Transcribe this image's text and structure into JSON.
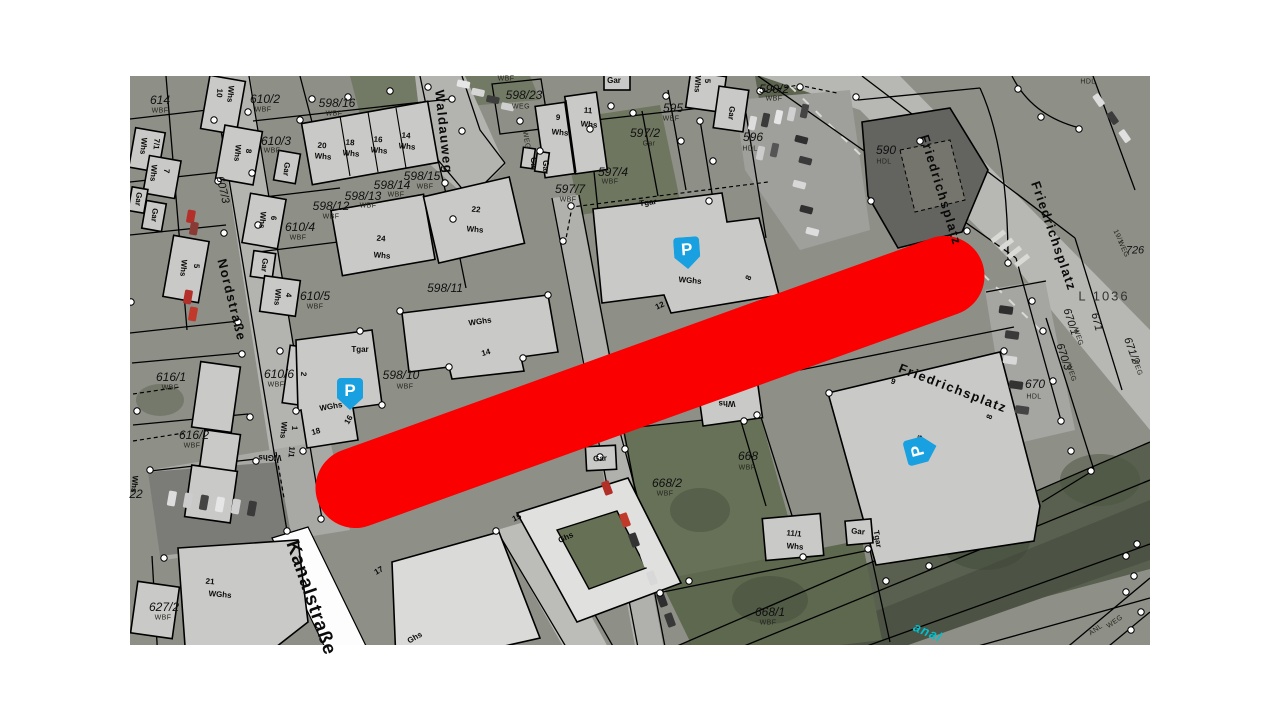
{
  "map": {
    "colors": {
      "highlight_red": "#fa0000",
      "parking_blue": "#18a0e0",
      "canal_cyan": "#00c0d0"
    },
    "parking": {
      "letter": "P",
      "spots": [
        {
          "x": 687,
          "y": 253,
          "r": -4
        },
        {
          "x": 350,
          "y": 394,
          "r": 0
        },
        {
          "x": 921,
          "y": 450,
          "r": -105
        }
      ]
    },
    "labels": [
      {
        "t": "Waldauweg",
        "x": 444,
        "y": 132,
        "r": 84,
        "c": "street"
      },
      {
        "t": "Nordstraße",
        "x": 232,
        "y": 300,
        "r": 76,
        "c": "street"
      },
      {
        "t": "Kanalstraße",
        "x": 311,
        "y": 598,
        "r": 71,
        "c": "street-lg"
      },
      {
        "t": "Friedrichsplatz",
        "x": 941,
        "y": 190,
        "r": 73,
        "c": "street"
      },
      {
        "t": "Friedrichsplatz",
        "x": 1054,
        "y": 236,
        "r": 71,
        "c": "street"
      },
      {
        "t": "Friedrichsplatz",
        "x": 953,
        "y": 388,
        "r": 21,
        "c": "street"
      },
      {
        "t": "anal",
        "x": 928,
        "y": 632,
        "r": 23,
        "c": "canal"
      },
      {
        "t": "L 1036",
        "x": 1104,
        "y": 296,
        "r": 0,
        "c": "lroad"
      },
      {
        "t": "607/3",
        "x": 222,
        "y": 190,
        "r": 77,
        "c": "roadnum"
      },
      {
        "t": "671",
        "x": 1096,
        "y": 322,
        "r": 76,
        "c": "roadnum"
      },
      {
        "t": "670/1",
        "x": 1070,
        "y": 322,
        "r": 72,
        "c": "roadnum"
      },
      {
        "t": "WEG",
        "x": 1078,
        "y": 337,
        "r": 72,
        "c": "sub"
      },
      {
        "t": "670/3",
        "x": 1063,
        "y": 357,
        "r": 72,
        "c": "roadnum"
      },
      {
        "t": "WEG",
        "x": 1071,
        "y": 373,
        "r": 72,
        "c": "sub"
      },
      {
        "t": "671/2",
        "x": 1131,
        "y": 351,
        "r": 70,
        "c": "roadnum"
      },
      {
        "t": "WEG",
        "x": 1137,
        "y": 367,
        "r": 70,
        "c": "sub"
      },
      {
        "t": "19/1",
        "x": 1118,
        "y": 237,
        "r": 65,
        "c": "sub"
      },
      {
        "t": "WEG",
        "x": 1123,
        "y": 249,
        "r": 65,
        "c": "sub"
      },
      {
        "t": "726",
        "x": 1135,
        "y": 251,
        "r": 0,
        "c": "roadnum"
      },
      {
        "t": "HDL",
        "x": 1088,
        "y": 82,
        "r": 0,
        "c": "sub"
      },
      {
        "t": "WEG",
        "x": 1115,
        "y": 622,
        "r": -35,
        "c": "sub"
      },
      {
        "t": "ANL",
        "x": 1096,
        "y": 630,
        "r": -35,
        "c": "sub"
      },
      {
        "t": "614",
        "x": 160,
        "y": 100,
        "r": 0,
        "c": "parcel"
      },
      {
        "t": "WBF",
        "x": 160,
        "y": 111,
        "r": 0,
        "c": "sub"
      },
      {
        "t": "610/2",
        "x": 265,
        "y": 99,
        "r": 0,
        "c": "parcel"
      },
      {
        "t": "WBF",
        "x": 263,
        "y": 110,
        "r": 0,
        "c": "sub"
      },
      {
        "t": "598/16",
        "x": 337,
        "y": 103,
        "r": 0,
        "c": "parcel"
      },
      {
        "t": "WBF",
        "x": 334,
        "y": 114,
        "r": 0,
        "c": "sub"
      },
      {
        "t": "610/3",
        "x": 276,
        "y": 141,
        "r": 0,
        "c": "parcel"
      },
      {
        "t": "WBF",
        "x": 272,
        "y": 151,
        "r": 0,
        "c": "sub"
      },
      {
        "t": "598/12",
        "x": 331,
        "y": 206,
        "r": 0,
        "c": "parcel"
      },
      {
        "t": "WBF",
        "x": 331,
        "y": 217,
        "r": 0,
        "c": "sub"
      },
      {
        "t": "598/13",
        "x": 363,
        "y": 196,
        "r": 0,
        "c": "parcel"
      },
      {
        "t": "WBF",
        "x": 368,
        "y": 206,
        "r": 0,
        "c": "sub"
      },
      {
        "t": "598/14",
        "x": 392,
        "y": 185,
        "r": 0,
        "c": "parcel"
      },
      {
        "t": "WBF",
        "x": 396,
        "y": 195,
        "r": 0,
        "c": "sub"
      },
      {
        "t": "598/15",
        "x": 422,
        "y": 176,
        "r": 0,
        "c": "parcel"
      },
      {
        "t": "WBF",
        "x": 425,
        "y": 187,
        "r": 0,
        "c": "sub"
      },
      {
        "t": "598/11",
        "x": 445,
        "y": 288,
        "r": 0,
        "c": "parcel"
      },
      {
        "t": "610/4",
        "x": 300,
        "y": 227,
        "r": 0,
        "c": "parcel"
      },
      {
        "t": "WBF",
        "x": 298,
        "y": 238,
        "r": 0,
        "c": "sub"
      },
      {
        "t": "610/5",
        "x": 315,
        "y": 296,
        "r": 0,
        "c": "parcel"
      },
      {
        "t": "WBF",
        "x": 315,
        "y": 307,
        "r": 0,
        "c": "sub"
      },
      {
        "t": "610/6",
        "x": 279,
        "y": 374,
        "r": 0,
        "c": "parcel"
      },
      {
        "t": "WBF",
        "x": 276,
        "y": 385,
        "r": 0,
        "c": "sub"
      },
      {
        "t": "616/1",
        "x": 171,
        "y": 377,
        "r": 0,
        "c": "parcel"
      },
      {
        "t": "WBF",
        "x": 170,
        "y": 388,
        "r": 0,
        "c": "sub"
      },
      {
        "t": "616/2",
        "x": 194,
        "y": 435,
        "r": 0,
        "c": "parcel"
      },
      {
        "t": "WBF",
        "x": 192,
        "y": 446,
        "r": 0,
        "c": "sub"
      },
      {
        "t": "627/2",
        "x": 164,
        "y": 607,
        "r": 0,
        "c": "parcel"
      },
      {
        "t": "WBF",
        "x": 163,
        "y": 618,
        "r": 0,
        "c": "sub"
      },
      {
        "t": "598/23",
        "x": 524,
        "y": 95,
        "r": 0,
        "c": "parcel"
      },
      {
        "t": "WEG",
        "x": 521,
        "y": 107,
        "r": 0,
        "c": "sub"
      },
      {
        "t": "597/2",
        "x": 645,
        "y": 133,
        "r": 0,
        "c": "parcel"
      },
      {
        "t": "Gar",
        "x": 649,
        "y": 144,
        "r": 0,
        "c": "sub"
      },
      {
        "t": "597/4",
        "x": 613,
        "y": 172,
        "r": 0,
        "c": "parcel"
      },
      {
        "t": "WBF",
        "x": 610,
        "y": 182,
        "r": 0,
        "c": "sub"
      },
      {
        "t": "597/7",
        "x": 570,
        "y": 189,
        "r": 0,
        "c": "parcel"
      },
      {
        "t": "WBF",
        "x": 568,
        "y": 200,
        "r": 0,
        "c": "sub"
      },
      {
        "t": "595",
        "x": 673,
        "y": 108,
        "r": 0,
        "c": "parcel"
      },
      {
        "t": "WBF",
        "x": 671,
        "y": 119,
        "r": 0,
        "c": "sub"
      },
      {
        "t": "596",
        "x": 753,
        "y": 137,
        "r": 0,
        "c": "parcel"
      },
      {
        "t": "HDL",
        "x": 750,
        "y": 149,
        "r": 0,
        "c": "sub"
      },
      {
        "t": "590/2",
        "x": 774,
        "y": 89,
        "r": 0,
        "c": "parcel"
      },
      {
        "t": "WBF",
        "x": 774,
        "y": 99,
        "r": 0,
        "c": "sub"
      },
      {
        "t": "590",
        "x": 886,
        "y": 150,
        "r": 0,
        "c": "parcel"
      },
      {
        "t": "HDL",
        "x": 884,
        "y": 162,
        "r": 0,
        "c": "sub"
      },
      {
        "t": "668/2",
        "x": 667,
        "y": 483,
        "r": 0,
        "c": "parcel"
      },
      {
        "t": "WBF",
        "x": 665,
        "y": 494,
        "r": 0,
        "c": "sub"
      },
      {
        "t": "668",
        "x": 748,
        "y": 456,
        "r": 0,
        "c": "parcel"
      },
      {
        "t": "WBF",
        "x": 747,
        "y": 468,
        "r": 0,
        "c": "sub"
      },
      {
        "t": "668/1",
        "x": 770,
        "y": 612,
        "r": 0,
        "c": "parcel"
      },
      {
        "t": "WBF",
        "x": 768,
        "y": 623,
        "r": 0,
        "c": "sub"
      },
      {
        "t": "670",
        "x": 1035,
        "y": 384,
        "r": 0,
        "c": "parcel"
      },
      {
        "t": "HDL",
        "x": 1034,
        "y": 397,
        "r": 0,
        "c": "sub"
      },
      {
        "t": "598/10",
        "x": 401,
        "y": 375,
        "r": 0,
        "c": "parcel"
      },
      {
        "t": "WBF",
        "x": 405,
        "y": 387,
        "r": 0,
        "c": "sub"
      },
      {
        "t": "22",
        "x": 136,
        "y": 494,
        "r": 0,
        "c": "parcel"
      },
      {
        "t": "WBF",
        "x": 506,
        "y": 79,
        "r": 0,
        "c": "sub"
      },
      {
        "t": "Whs",
        "x": 230,
        "y": 94,
        "r": 95,
        "c": "bldg"
      },
      {
        "t": "10",
        "x": 219,
        "y": 93,
        "r": 95,
        "c": "bldg"
      },
      {
        "t": "Whs",
        "x": 143,
        "y": 146,
        "r": 95,
        "c": "bldg"
      },
      {
        "t": "7/1",
        "x": 156,
        "y": 144,
        "r": 95,
        "c": "bldg"
      },
      {
        "t": "Whs",
        "x": 153,
        "y": 173,
        "r": 95,
        "c": "bldg"
      },
      {
        "t": "7",
        "x": 166,
        "y": 171,
        "r": 95,
        "c": "bldg"
      },
      {
        "t": "Gar",
        "x": 138,
        "y": 199,
        "r": 95,
        "c": "bldg"
      },
      {
        "t": "Gar",
        "x": 154,
        "y": 215,
        "r": 95,
        "c": "bldg"
      },
      {
        "t": "Whs",
        "x": 183,
        "y": 268,
        "r": 95,
        "c": "bldg"
      },
      {
        "t": "5",
        "x": 196,
        "y": 266,
        "r": 95,
        "c": "bldg"
      },
      {
        "t": "Whs",
        "x": 237,
        "y": 153,
        "r": 95,
        "c": "bldg"
      },
      {
        "t": "8",
        "x": 248,
        "y": 151,
        "r": 95,
        "c": "bldg"
      },
      {
        "t": "Gar",
        "x": 286,
        "y": 169,
        "r": 95,
        "c": "bldg"
      },
      {
        "t": "Whs",
        "x": 262,
        "y": 220,
        "r": 95,
        "c": "bldg"
      },
      {
        "t": "6",
        "x": 273,
        "y": 218,
        "r": 95,
        "c": "bldg"
      },
      {
        "t": "Gar",
        "x": 264,
        "y": 265,
        "r": 95,
        "c": "bldg"
      },
      {
        "t": "Whs",
        "x": 277,
        "y": 297,
        "r": 95,
        "c": "bldg"
      },
      {
        "t": "4",
        "x": 288,
        "y": 295,
        "r": 95,
        "c": "bldg"
      },
      {
        "t": "2",
        "x": 303,
        "y": 374,
        "r": 95,
        "c": "bldg"
      },
      {
        "t": "Whs",
        "x": 283,
        "y": 430,
        "r": 95,
        "c": "bldg"
      },
      {
        "t": "1",
        "x": 294,
        "y": 428,
        "r": 95,
        "c": "bldg"
      },
      {
        "t": "WGhs",
        "x": 270,
        "y": 457,
        "r": 180,
        "c": "bldg"
      },
      {
        "t": "1/1",
        "x": 291,
        "y": 452,
        "r": 95,
        "c": "bldg"
      },
      {
        "t": "20",
        "x": 322,
        "y": 146,
        "r": 5,
        "c": "bldg"
      },
      {
        "t": "Whs",
        "x": 323,
        "y": 157,
        "r": 5,
        "c": "bldg"
      },
      {
        "t": "18",
        "x": 350,
        "y": 143,
        "r": 5,
        "c": "bldg"
      },
      {
        "t": "Whs",
        "x": 351,
        "y": 154,
        "r": 5,
        "c": "bldg"
      },
      {
        "t": "16",
        "x": 378,
        "y": 140,
        "r": 5,
        "c": "bldg"
      },
      {
        "t": "Whs",
        "x": 379,
        "y": 151,
        "r": 5,
        "c": "bldg"
      },
      {
        "t": "14",
        "x": 406,
        "y": 136,
        "r": 5,
        "c": "bldg"
      },
      {
        "t": "Whs",
        "x": 407,
        "y": 147,
        "r": 5,
        "c": "bldg"
      },
      {
        "t": "24",
        "x": 381,
        "y": 239,
        "r": 5,
        "c": "bldg"
      },
      {
        "t": "Whs",
        "x": 382,
        "y": 256,
        "r": 5,
        "c": "bldg"
      },
      {
        "t": "22",
        "x": 476,
        "y": 210,
        "r": 5,
        "c": "bldg"
      },
      {
        "t": "Whs",
        "x": 475,
        "y": 230,
        "r": 5,
        "c": "bldg"
      },
      {
        "t": "9",
        "x": 558,
        "y": 118,
        "r": 5,
        "c": "bldg"
      },
      {
        "t": "Whs",
        "x": 560,
        "y": 133,
        "r": 5,
        "c": "bldg"
      },
      {
        "t": "11",
        "x": 588,
        "y": 111,
        "r": 5,
        "c": "bldg"
      },
      {
        "t": "Whs",
        "x": 589,
        "y": 125,
        "r": 5,
        "c": "bldg"
      },
      {
        "t": "Gar",
        "x": 614,
        "y": 81,
        "r": 0,
        "c": "bldg"
      },
      {
        "t": "Gar",
        "x": 731,
        "y": 113,
        "r": 95,
        "c": "bldg"
      },
      {
        "t": "Whs",
        "x": 697,
        "y": 84,
        "r": 93,
        "c": "bldg"
      },
      {
        "t": "5",
        "x": 707,
        "y": 81,
        "r": 93,
        "c": "bldg"
      },
      {
        "t": "Gar",
        "x": 533,
        "y": 164,
        "r": 90,
        "c": "bldg"
      },
      {
        "t": "Gar",
        "x": 545,
        "y": 167,
        "r": 90,
        "c": "bldg"
      },
      {
        "t": "WEG",
        "x": 526,
        "y": 140,
        "r": 80,
        "c": "sub"
      },
      {
        "t": "WGhs",
        "x": 690,
        "y": 281,
        "r": 5,
        "c": "bldg"
      },
      {
        "t": "8",
        "x": 749,
        "y": 278,
        "r": -65,
        "c": "bldg"
      },
      {
        "t": "12",
        "x": 660,
        "y": 306,
        "r": -25,
        "c": "bldg"
      },
      {
        "t": "Tgar",
        "x": 648,
        "y": 203,
        "r": -8,
        "c": "bldg"
      },
      {
        "t": "WGhs",
        "x": 480,
        "y": 322,
        "r": -8,
        "c": "bldg"
      },
      {
        "t": "14",
        "x": 486,
        "y": 353,
        "r": -15,
        "c": "bldg"
      },
      {
        "t": "WGhs",
        "x": 331,
        "y": 407,
        "r": -10,
        "c": "bldg"
      },
      {
        "t": "16",
        "x": 349,
        "y": 420,
        "r": -60,
        "c": "bldg"
      },
      {
        "t": "18",
        "x": 316,
        "y": 432,
        "r": -15,
        "c": "bldg"
      },
      {
        "t": "Tgar",
        "x": 360,
        "y": 350,
        "r": 0,
        "c": "bldg"
      },
      {
        "t": "Tgar",
        "x": 877,
        "y": 539,
        "r": 80,
        "c": "bldg"
      },
      {
        "t": "21",
        "x": 210,
        "y": 582,
        "r": 5,
        "c": "bldg"
      },
      {
        "t": "WGhs",
        "x": 220,
        "y": 595,
        "r": 5,
        "c": "bldg"
      },
      {
        "t": "17",
        "x": 379,
        "y": 571,
        "r": -30,
        "c": "bldg"
      },
      {
        "t": "15",
        "x": 517,
        "y": 518,
        "r": -25,
        "c": "bldg"
      },
      {
        "t": "Ghs",
        "x": 566,
        "y": 538,
        "r": -25,
        "c": "bldg"
      },
      {
        "t": "Ghs",
        "x": 415,
        "y": 638,
        "r": -30,
        "c": "bldg"
      },
      {
        "t": "WGhs",
        "x": 917,
        "y": 446,
        "r": -72,
        "c": "bldg"
      },
      {
        "t": "9",
        "x": 893,
        "y": 382,
        "r": 20,
        "c": "bldg"
      },
      {
        "t": "8",
        "x": 990,
        "y": 417,
        "r": -70,
        "c": "bldg"
      },
      {
        "t": "11/1",
        "x": 794,
        "y": 534,
        "r": 5,
        "c": "bldg"
      },
      {
        "t": "Whs",
        "x": 795,
        "y": 547,
        "r": 5,
        "c": "bldg"
      },
      {
        "t": "Gar",
        "x": 858,
        "y": 532,
        "r": 5,
        "c": "bldg"
      },
      {
        "t": "Whs",
        "x": 727,
        "y": 403,
        "r": 180,
        "c": "bldg"
      },
      {
        "t": "Whs",
        "x": 134,
        "y": 484,
        "r": 95,
        "c": "bldg"
      },
      {
        "t": "Gar",
        "x": 600,
        "y": 459,
        "r": -3,
        "c": "bldg"
      }
    ]
  }
}
